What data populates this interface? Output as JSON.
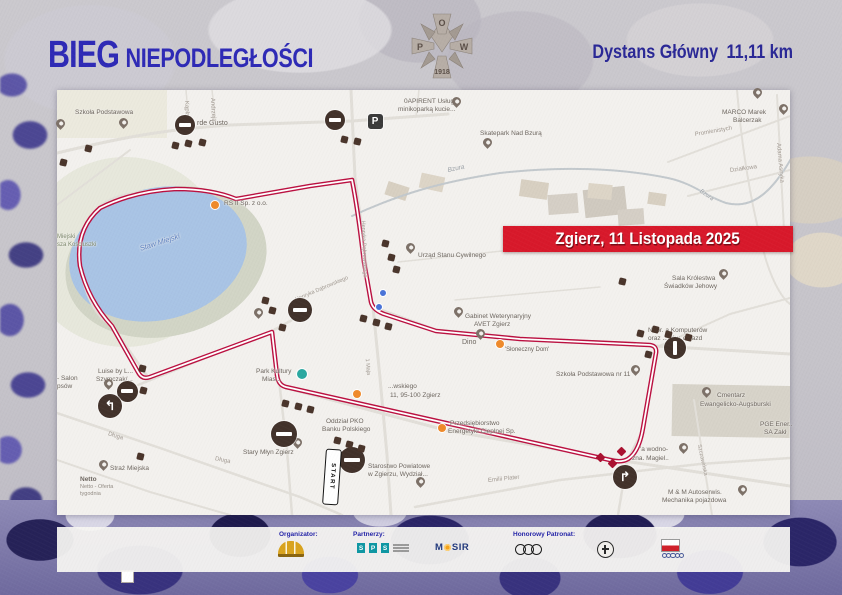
{
  "header": {
    "title_bold": "BIEG",
    "title_rest": "NIEPODLEGŁOŚCI",
    "distance_label": "Dystans Główny",
    "distance_value": "11,11 km",
    "title_color": "#2e2ab6",
    "badge": {
      "top": "O",
      "left": "P",
      "right": "W",
      "year": "1918",
      "name": "POW 1918 badge"
    }
  },
  "banner": {
    "text": "Zgierz, 11 Listopada 2025",
    "bg": "#d8192b"
  },
  "map": {
    "start_sign": "START",
    "colors": {
      "road": "#e2dfd9",
      "river": "#c3c9cd",
      "route_outer": "#bb1040",
      "route_inner": "#ffffff",
      "lake": "#a9c4e5",
      "label_default": "#6e6760",
      "street": "#a29a92"
    },
    "route": {
      "d": "M272,332 L150,377 Q142,380 138,372 L112,326 Q88,300 80,266 Q75,230 100,208 Q134,191 176,189 Q212,189 236,199 L310,186 L352,180 Q358,210 364,262 L371,302 Q373,310 384,314 L436,331 L520,339 L650,345 Q657,346 656,353 L643,428 Q639,452 628,459 Q621,463 610,460 L286,387 Q278,385 277,375 Z"
    },
    "areas": [
      {
        "sh": "e",
        "x": 125,
        "y": 252,
        "rx": 100,
        "ry": 95,
        "f": "#e7e8dc",
        "n": "park-area"
      },
      {
        "sh": "e",
        "x": 166,
        "y": 262,
        "rx": 102,
        "ry": 74,
        "r": -14,
        "f": "#d2d5c6",
        "n": "lake-shore"
      },
      {
        "sh": "e",
        "x": 158,
        "y": 254,
        "rx": 90,
        "ry": 66,
        "r": -14,
        "f": "#a9c4e5",
        "n": "lake"
      },
      {
        "sh": "r",
        "x": 57,
        "y": 90,
        "w": 110,
        "h": 48,
        "f": "#eceade",
        "n": "park-area"
      },
      {
        "sh": "r",
        "x": 672,
        "y": 385,
        "w": 118,
        "h": 52,
        "r": 1,
        "f": "#d7d3c9",
        "n": "cemetery-area"
      },
      {
        "sh": "r",
        "x": 548,
        "y": 194,
        "w": 30,
        "h": 20,
        "r": -4,
        "f": "#d5cfc6",
        "n": "building"
      },
      {
        "sh": "r",
        "x": 584,
        "y": 188,
        "w": 42,
        "h": 28,
        "r": -6,
        "f": "#d0cac0",
        "n": "building"
      },
      {
        "sh": "r",
        "x": 618,
        "y": 209,
        "w": 26,
        "h": 16,
        "r": -4,
        "f": "#d5cfc6",
        "n": "building"
      },
      {
        "sh": "r",
        "x": 386,
        "y": 184,
        "w": 22,
        "h": 14,
        "r": 18,
        "f": "#d8d0c2",
        "n": "building"
      },
      {
        "sh": "r",
        "x": 420,
        "y": 175,
        "w": 24,
        "h": 15,
        "r": 12,
        "f": "#ddd5c7",
        "n": "building"
      },
      {
        "sh": "r",
        "x": 520,
        "y": 181,
        "w": 28,
        "h": 17,
        "r": 8,
        "f": "#d8d0c2",
        "n": "building"
      },
      {
        "sh": "r",
        "x": 588,
        "y": 184,
        "w": 24,
        "h": 15,
        "r": 5,
        "f": "#ddd5c7",
        "n": "building"
      },
      {
        "sh": "r",
        "x": 648,
        "y": 193,
        "w": 18,
        "h": 12,
        "r": 8,
        "f": "#d8d0c2",
        "n": "building"
      }
    ],
    "roads": [
      {
        "d": "M57,153 C120,138 160,130 230,125 L352,121 L448,114",
        "w": 3
      },
      {
        "d": "M351,90 L355,178 L362,230 L368,283 L373,307 L380,378 L387,455 L391,515",
        "w": 3
      },
      {
        "d": "M236,199 C200,188 160,186 120,196 C88,206 76,232 80,266 C86,300 98,318 112,326 L150,380",
        "w": 2.5
      },
      {
        "d": "M138,385 L272,331 L312,309",
        "w": 2.5
      },
      {
        "d": "M272,331 L279,380 L287,450 L292,515",
        "w": 2.5
      },
      {
        "d": "M373,307 L436,330 L540,340 L656,346 L790,354",
        "w": 3
      },
      {
        "d": "M656,346 L643,430 L627,461 L618,515",
        "w": 2.5
      },
      {
        "d": "M283,387 L445,430 L624,461 L790,486",
        "w": 3
      },
      {
        "d": "M57,413 L160,448 L300,497 L342,515",
        "w": 2.5
      },
      {
        "d": "M415,507 L560,480 L700,464 L790,458",
        "w": 2.5
      },
      {
        "d": "M694,400 L704,465 L712,515",
        "w": 2
      },
      {
        "d": "M777,95 L784,230",
        "w": 2
      },
      {
        "d": "M668,162 L790,116",
        "w": 2
      },
      {
        "d": "M688,196 L790,170",
        "w": 2
      },
      {
        "d": "M186,90 L189,125",
        "w": 1.5
      },
      {
        "d": "M212,90 L216,124",
        "w": 1.5
      },
      {
        "d": "M419,90 L416,116",
        "w": 1.5
      },
      {
        "d": "M657,347 L730,314 L790,298",
        "w": 2
      },
      {
        "d": "M737,90 C742,150 752,210 766,260 C774,286 784,300 790,304",
        "w": 2
      },
      {
        "d": "M398,262 L540,247",
        "w": 1.5
      },
      {
        "d": "M455,300 L600,287",
        "w": 1.5
      },
      {
        "d": "M57,205 L130,150",
        "w": 2
      },
      {
        "d": "M57,460 L150,492 L230,515",
        "w": 2
      },
      {
        "d": "M352,216 C400,194 440,182 500,173 C560,166 620,168 668,178 C695,184 705,196 726,203 C750,209 770,196 792,157",
        "w": 2,
        "c": "#c3c9cd"
      }
    ],
    "labels": [
      {
        "t": "Szkoła Podstawowa",
        "x": 75,
        "y": 110
      },
      {
        "t": "rde Gusto",
        "x": 197,
        "y": 120,
        "s": 7
      },
      {
        "t": "0APIRENT Usługi",
        "x": 404,
        "y": 99
      },
      {
        "t": "minikoparką kucie...",
        "x": 398,
        "y": 107
      },
      {
        "t": "Skatepark Nad Bzurą",
        "x": 480,
        "y": 131
      },
      {
        "t": "MARCO Marek",
        "x": 722,
        "y": 110
      },
      {
        "t": "Balcerzak",
        "x": 733,
        "y": 118
      },
      {
        "t": "Promienistych",
        "x": 695,
        "y": 132,
        "r": -10,
        "c": "#a29a92",
        "s": 6
      },
      {
        "t": "Działkowa",
        "x": 730,
        "y": 168,
        "r": -8,
        "c": "#a29a92",
        "s": 6
      },
      {
        "t": "Adama Asnyka",
        "x": 778,
        "y": 140,
        "r": 85,
        "c": "#a29a92",
        "s": 6
      },
      {
        "t": "Andrzeja",
        "x": 212,
        "y": 95,
        "r": 87,
        "c": "#a29a92",
        "s": 6
      },
      {
        "t": "Kąpla",
        "x": 186,
        "y": 98,
        "r": 87,
        "c": "#a29a92",
        "s": 6
      },
      {
        "t": "Bzura",
        "x": 448,
        "y": 168,
        "r": -12,
        "c": "#9aa0a6",
        "s": 6.5,
        "i": true
      },
      {
        "t": "Bzura",
        "x": 700,
        "y": 188,
        "r": 35,
        "c": "#9aa0a6",
        "s": 6,
        "i": true
      },
      {
        "t": "RS II Sp. z o.o.",
        "x": 224,
        "y": 201
      },
      {
        "t": "Staw Miejski",
        "x": 140,
        "y": 245,
        "r": -18,
        "c": "#5f82c2",
        "s": 7.5,
        "i": true
      },
      {
        "t": "Miejski",
        "x": 57,
        "y": 234,
        "c": "#7f8a6e",
        "s": 6
      },
      {
        "t": "sza Kościuszki",
        "x": 57,
        "y": 242,
        "c": "#7f8a6e",
        "s": 6
      },
      {
        "t": "Urząd Stanu Cywilnego",
        "x": 418,
        "y": 253
      },
      {
        "t": "Henryka Dąbrowskiego",
        "x": 362,
        "y": 218,
        "r": 88,
        "c": "#a29a92",
        "s": 5.5
      },
      {
        "t": "Henryka Dąbrowskiego",
        "x": 296,
        "y": 298,
        "r": -23,
        "c": "#a29a92",
        "s": 5.5
      },
      {
        "t": "Sala Królestwa",
        "x": 672,
        "y": 276
      },
      {
        "t": "Świadków Jehowy",
        "x": 664,
        "y": 284
      },
      {
        "t": "Gabinet Weterynaryjny",
        "x": 465,
        "y": 314
      },
      {
        "t": "AVET Zgierz",
        "x": 474,
        "y": 322
      },
      {
        "t": "Dino",
        "x": 462,
        "y": 339,
        "s": 7
      },
      {
        "t": "'Słoneczny Dom'",
        "x": 505,
        "y": 347,
        "s": 6
      },
      {
        "t": "Napr. a Komputerów",
        "x": 648,
        "y": 328
      },
      {
        "t": "oraz ...dów. dojazd",
        "x": 648,
        "y": 336
      },
      {
        "t": "Szkoła Podstawowa nr 11",
        "x": 556,
        "y": 372
      },
      {
        "t": "Cmentarz",
        "x": 717,
        "y": 393
      },
      {
        "t": "Ewangelicko-Augsburski",
        "x": 700,
        "y": 402
      },
      {
        "t": "PGE Ener..",
        "x": 760,
        "y": 422
      },
      {
        "t": "SA Zakł",
        "x": 764,
        "y": 430
      },
      {
        "t": "'a wodno-",
        "x": 640,
        "y": 447
      },
      {
        "t": "zna. Magiel..",
        "x": 632,
        "y": 456
      },
      {
        "t": "Szczawińska",
        "x": 698,
        "y": 442,
        "r": 78,
        "c": "#a29a92",
        "s": 5.5
      },
      {
        "t": "M & M Autoserwis.",
        "x": 668,
        "y": 490
      },
      {
        "t": "Mechanika pojazdowa",
        "x": 662,
        "y": 498
      },
      {
        "t": "Emilii Plater",
        "x": 488,
        "y": 478,
        "r": -6,
        "c": "#a29a92",
        "s": 6
      },
      {
        "t": "Starostwo Powiatowe",
        "x": 368,
        "y": 464
      },
      {
        "t": "w Zgierzu, Wydział...",
        "x": 368,
        "y": 472
      },
      {
        "t": "Oddział PKO",
        "x": 326,
        "y": 419
      },
      {
        "t": "Banku Polskiego",
        "x": 322,
        "y": 427
      },
      {
        "t": "Stary Młyn Zgierz",
        "x": 243,
        "y": 450
      },
      {
        "t": "Netto",
        "x": 80,
        "y": 477,
        "s": 6.5,
        "b": true
      },
      {
        "t": "Netto - Oferta",
        "x": 80,
        "y": 485,
        "s": 5.5,
        "c": "#938c84"
      },
      {
        "t": "tygodnia",
        "x": 80,
        "y": 492,
        "s": 5.5,
        "c": "#938c84"
      },
      {
        "t": "Straż Miejska",
        "x": 110,
        "y": 466
      },
      {
        "t": "Luise by L...",
        "x": 98,
        "y": 369
      },
      {
        "t": "Szymczak/...",
        "x": 96,
        "y": 377
      },
      {
        "t": "- Salon",
        "x": 57,
        "y": 376
      },
      {
        "t": "psów",
        "x": 57,
        "y": 384
      },
      {
        "t": "Park Kultury",
        "x": 256,
        "y": 369
      },
      {
        "t": "Mias...",
        "x": 262,
        "y": 377
      },
      {
        "t": "...wskiego",
        "x": 388,
        "y": 384
      },
      {
        "t": "11, 95-100 Zgierz",
        "x": 390,
        "y": 393
      },
      {
        "t": "Przedsiębiorstwo",
        "x": 450,
        "y": 421
      },
      {
        "t": "Energetyki Cieplnej Sp.",
        "x": 448,
        "y": 429
      },
      {
        "t": "1 Maja",
        "x": 366,
        "y": 356,
        "r": 85,
        "c": "#a29a92",
        "s": 5.5
      },
      {
        "t": "Długa",
        "x": 108,
        "y": 431,
        "r": 18,
        "c": "#a29a92",
        "s": 6
      },
      {
        "t": "Długa",
        "x": 215,
        "y": 456,
        "r": 12,
        "c": "#a29a92",
        "s": 6
      }
    ],
    "pins": [
      [
        60,
        128
      ],
      [
        123,
        127
      ],
      [
        456,
        106
      ],
      [
        487,
        147
      ],
      [
        757,
        97
      ],
      [
        783,
        113
      ],
      [
        410,
        252
      ],
      [
        258,
        317
      ],
      [
        458,
        316
      ],
      [
        723,
        278
      ],
      [
        706,
        396
      ],
      [
        635,
        374
      ],
      [
        683,
        452
      ],
      [
        742,
        494
      ],
      [
        297,
        447
      ],
      [
        103,
        469
      ],
      [
        108,
        388
      ],
      [
        420,
        486
      ],
      [
        480,
        338
      ]
    ],
    "no_entry": [
      {
        "x": 185,
        "y": 125,
        "d": 20
      },
      {
        "x": 335,
        "y": 120,
        "d": 20
      },
      {
        "x": 300,
        "y": 310,
        "d": 24
      },
      {
        "x": 127,
        "y": 391,
        "d": 21
      },
      {
        "x": 284,
        "y": 434,
        "d": 26
      },
      {
        "x": 352,
        "y": 460,
        "d": 26
      },
      {
        "x": 675,
        "y": 348,
        "d": 22,
        "bar": "v"
      }
    ],
    "turns": [
      {
        "x": 110,
        "y": 406,
        "d": 24,
        "g": "↰"
      },
      {
        "x": 625,
        "y": 477,
        "d": 24,
        "g": "↱"
      }
    ],
    "parking": {
      "x": 375,
      "y": 121,
      "d": 15,
      "g": "P"
    },
    "orange_dots": [
      [
        215,
        205
      ],
      [
        357,
        394
      ],
      [
        442,
        428
      ],
      [
        500,
        344
      ]
    ],
    "blue_dots": [
      [
        383,
        293
      ],
      [
        379,
        307
      ]
    ],
    "teal_dots": [
      [
        302,
        374
      ]
    ],
    "squares": [
      [
        175,
        145
      ],
      [
        188,
        143
      ],
      [
        202,
        142
      ],
      [
        88,
        148
      ],
      [
        63,
        162
      ],
      [
        344,
        139
      ],
      [
        357,
        141
      ],
      [
        385,
        243
      ],
      [
        391,
        257
      ],
      [
        396,
        269
      ],
      [
        265,
        300
      ],
      [
        272,
        310
      ],
      [
        282,
        327
      ],
      [
        363,
        318
      ],
      [
        376,
        322
      ],
      [
        388,
        326
      ],
      [
        285,
        403
      ],
      [
        298,
        406
      ],
      [
        310,
        409
      ],
      [
        337,
        440
      ],
      [
        349,
        444
      ],
      [
        361,
        448
      ],
      [
        142,
        368
      ],
      [
        143,
        390
      ],
      [
        640,
        333
      ],
      [
        655,
        329
      ],
      [
        668,
        334
      ],
      [
        648,
        354
      ],
      [
        622,
        281
      ],
      [
        688,
        337
      ],
      [
        140,
        456
      ]
    ],
    "diamonds": [
      [
        600,
        457
      ],
      [
        612,
        463
      ],
      [
        621,
        451
      ]
    ]
  },
  "footer": {
    "organizer_label": "Organizator:",
    "partners_label": "Partnerzy:",
    "patronage_label": "Honorowy Patronat:",
    "sps_letters": [
      "S",
      "P",
      "S"
    ],
    "mosir_text_left": "M",
    "mosir_text_right": "SIR"
  }
}
